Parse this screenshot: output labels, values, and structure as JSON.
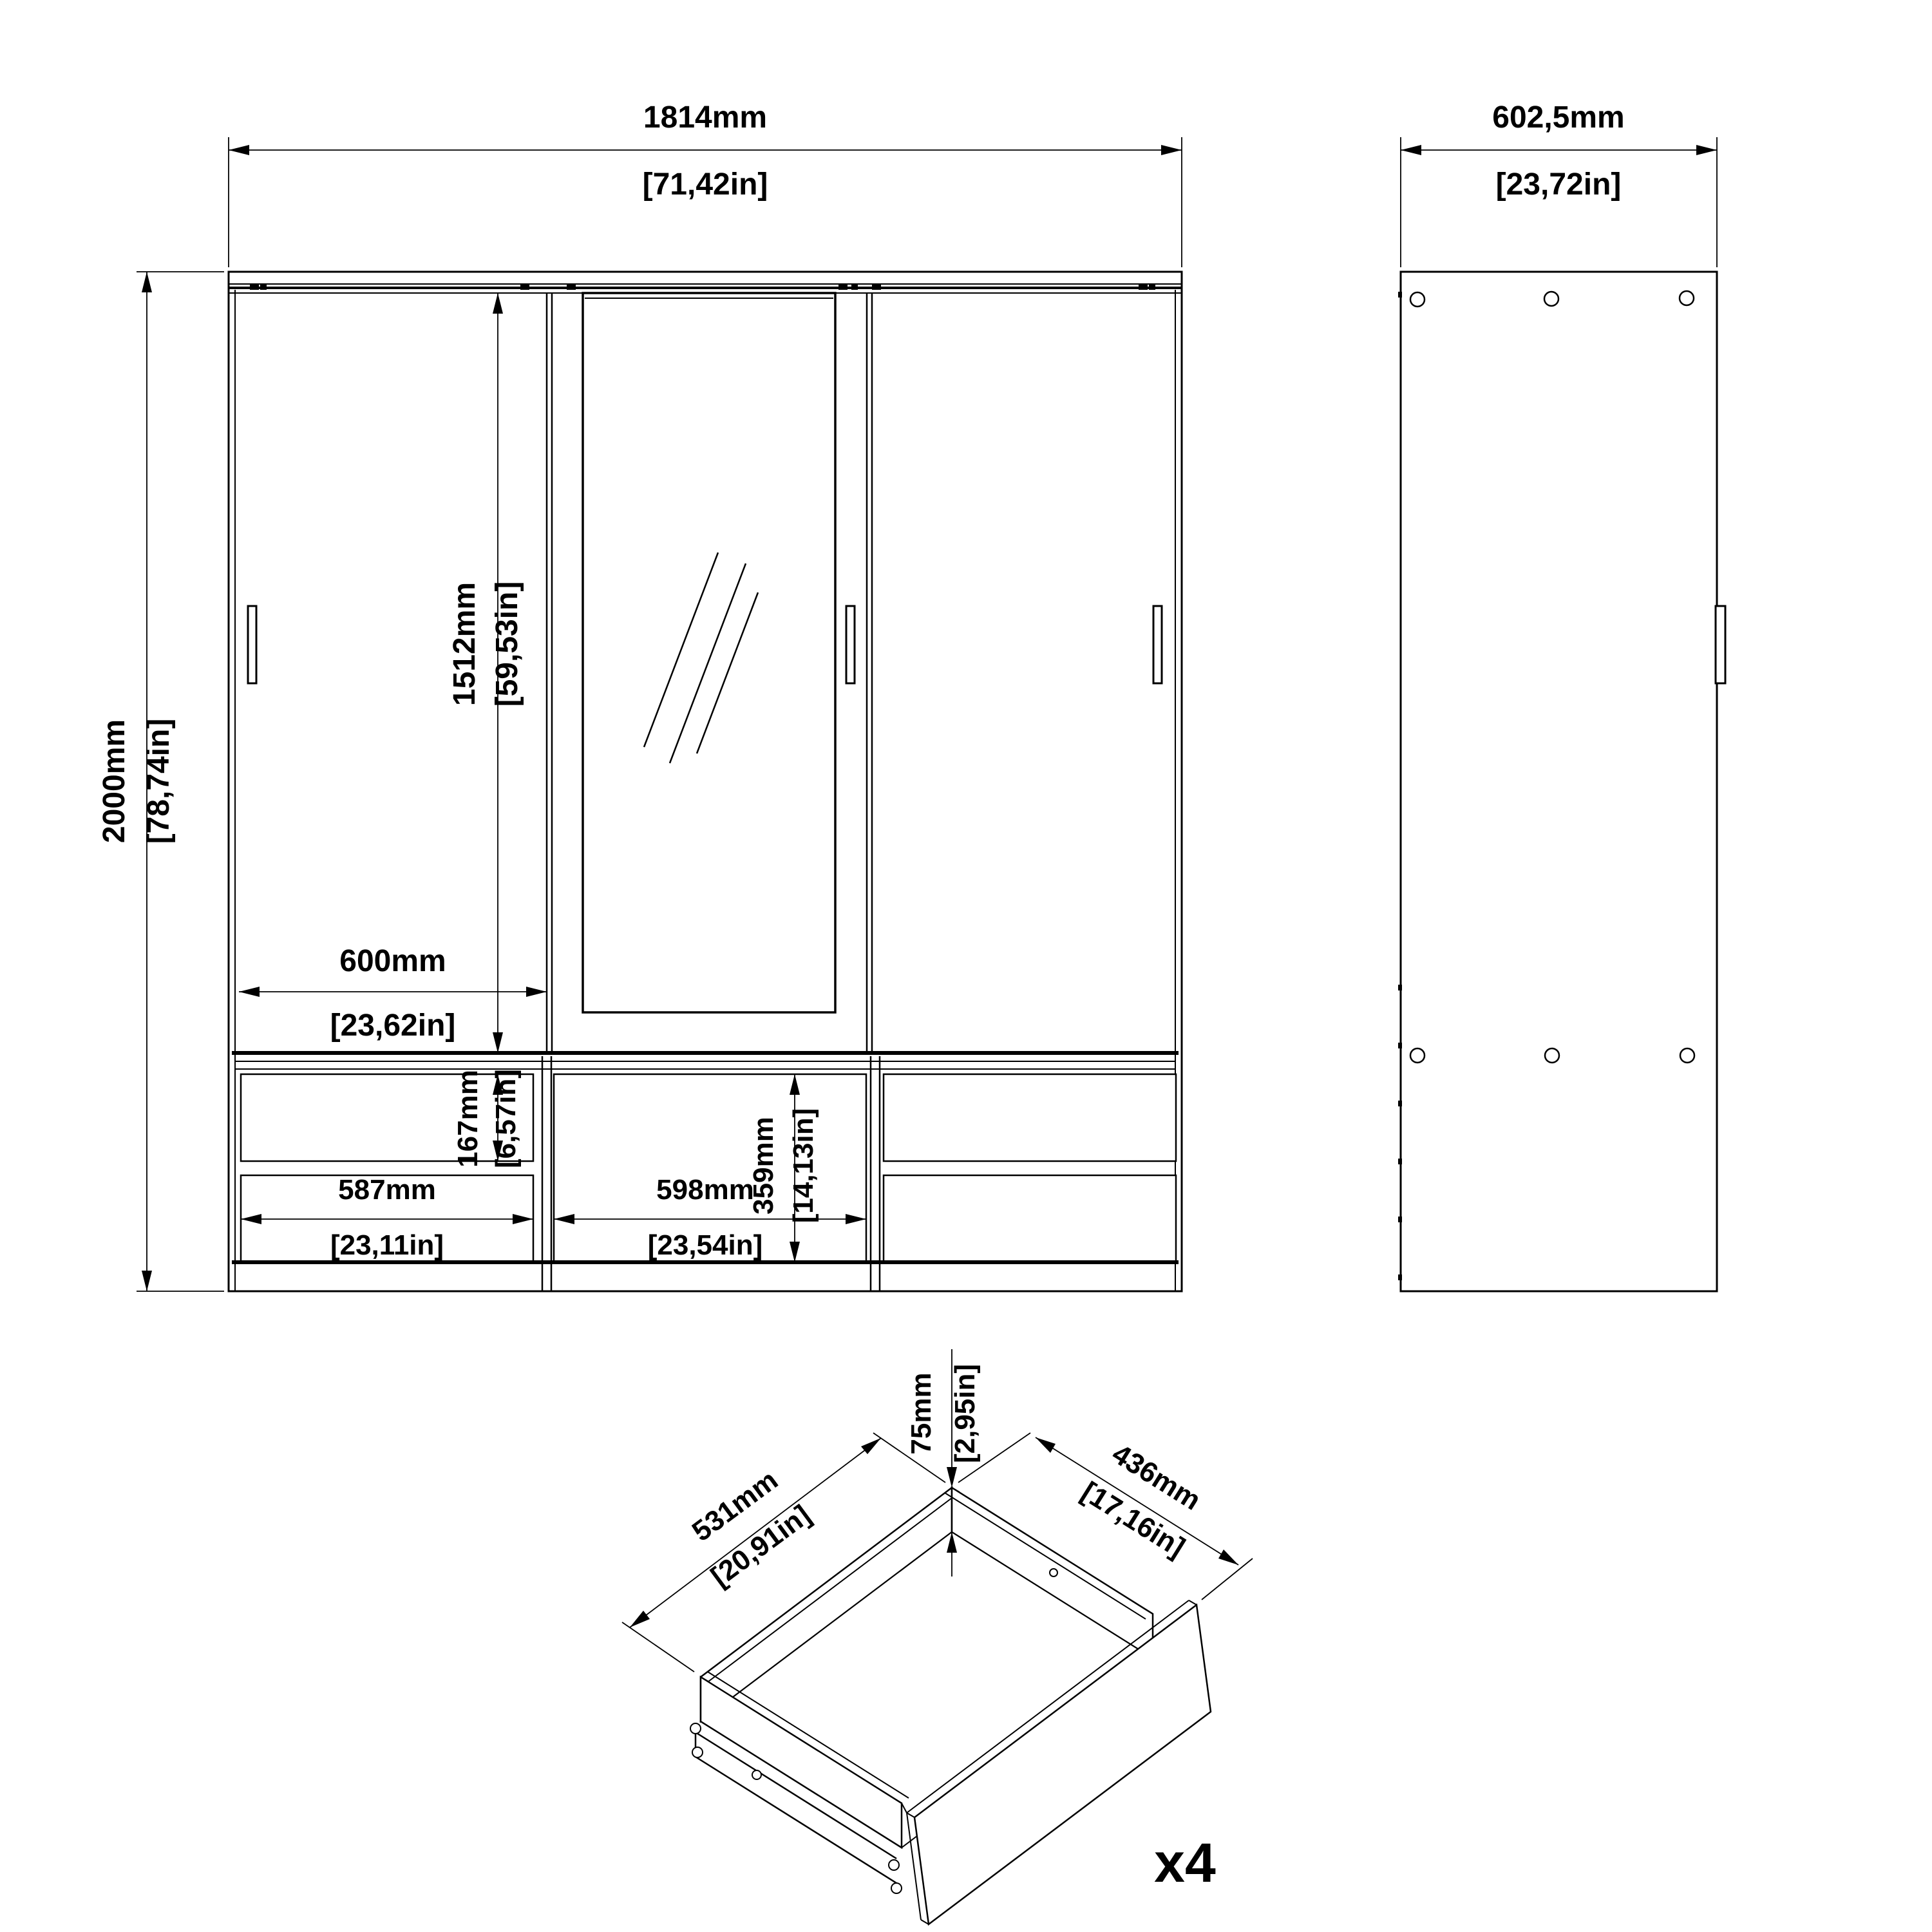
{
  "drawing": {
    "title": "Wardrobe with 3 sliding doors, mirror and 4 drawers - dimensional drawing",
    "line_color": "#000000",
    "background_color": "#ffffff",
    "front_view": {
      "overall_width": {
        "metric": "1814mm",
        "imperial": "[71,42in]"
      },
      "overall_height": {
        "metric": "2000mm",
        "imperial": "[78,74in]"
      },
      "door_height": {
        "metric": "1512mm",
        "imperial": "[59,53in]"
      },
      "door_width": {
        "metric": "600mm",
        "imperial": "[23,62in]"
      },
      "top_drawer_height": {
        "metric": "167mm",
        "imperial": "[6,57in]"
      },
      "middle_front_height": {
        "metric": "359mm",
        "imperial": "[14,13in]"
      },
      "left_drawer_width": {
        "metric": "587mm",
        "imperial": "[23,11in]"
      },
      "middle_drawer_width": {
        "metric": "598mm",
        "imperial": "[23,54in]"
      }
    },
    "side_view": {
      "depth": {
        "metric": "602,5mm",
        "imperial": "[23,72in]"
      }
    },
    "drawer_detail": {
      "height": {
        "metric": "75mm",
        "imperial": "[2,95in]"
      },
      "width": {
        "metric": "531mm",
        "imperial": "[20,91in]"
      },
      "depth": {
        "metric": "436mm",
        "imperial": "[17,16in]"
      },
      "quantity_label": "x4"
    }
  }
}
